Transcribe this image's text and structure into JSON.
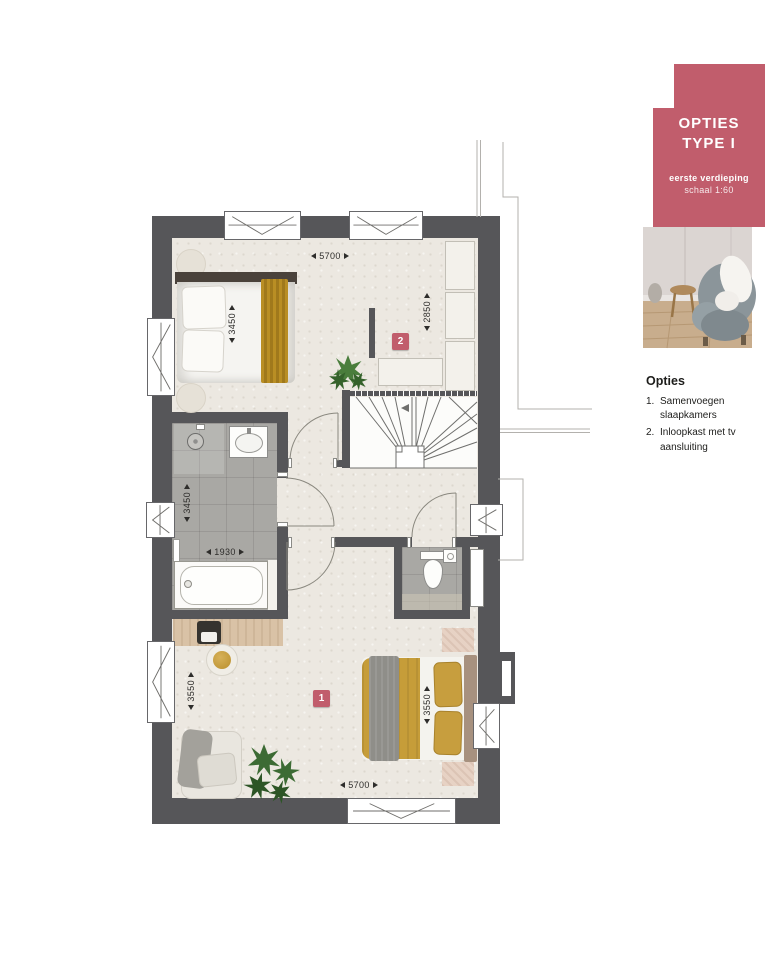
{
  "panel": {
    "card": {
      "title_line1": "OPTIES",
      "title_line2": "TYPE I",
      "subtitle": "eerste verdieping",
      "scale": "schaal 1:60"
    },
    "options": {
      "heading": "Opties",
      "items": [
        {
          "num": "1.",
          "label": "Samenvoegen slaapkamers"
        },
        {
          "num": "2.",
          "label": "Inloopkast met tv aansluiting"
        }
      ]
    }
  },
  "plan": {
    "markers": [
      {
        "label": "1"
      },
      {
        "label": "2"
      }
    ],
    "dims": [
      {
        "id": "top-width",
        "value": "5700"
      },
      {
        "id": "closet-depth",
        "value": "2850"
      },
      {
        "id": "bed2-length",
        "value": "3450"
      },
      {
        "id": "bathroom-length",
        "value": "3450"
      },
      {
        "id": "bathroom-width",
        "value": "1930"
      },
      {
        "id": "room1-depth",
        "value": "3550"
      },
      {
        "id": "bed1-length",
        "value": "3550"
      },
      {
        "id": "bottom-width",
        "value": "5700"
      }
    ]
  },
  "colors": {
    "accent": "#c15d6c",
    "wall": "#565659",
    "floor": "#ece8e1",
    "tile": "#a9a8a4"
  }
}
